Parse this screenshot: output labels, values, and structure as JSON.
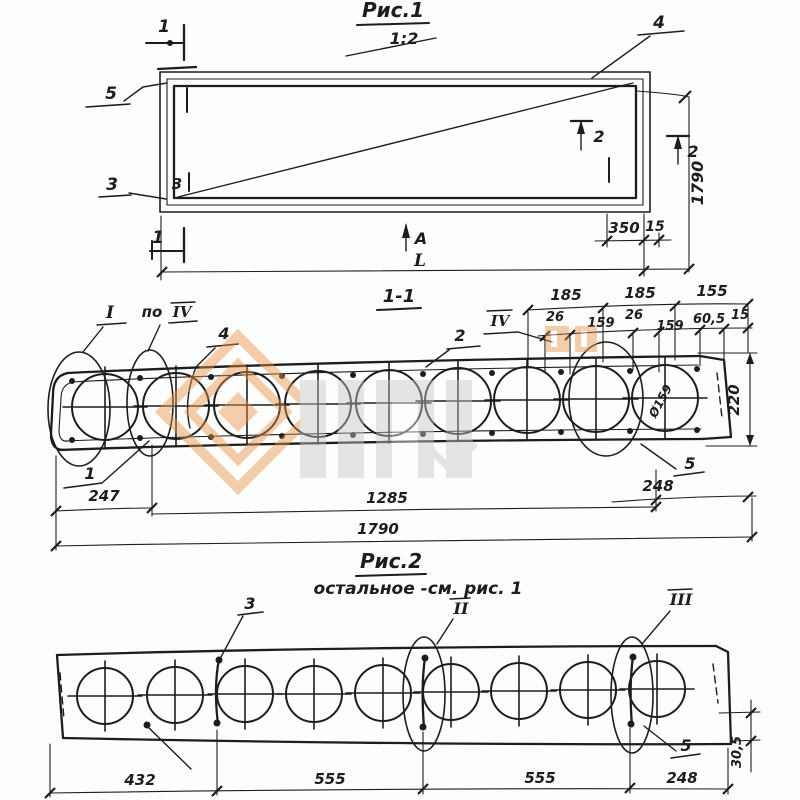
{
  "fig1": {
    "title": "Рис.1",
    "scale": "1:2",
    "section_mark_top": "1",
    "section_mark_bottom": "1",
    "callout_5": "5",
    "callout_3": "3",
    "inner_mark_3": "3",
    "callout_4": "4",
    "section_mark_2_inner": "2",
    "section_mark_2_outer": "2",
    "dim_width": "1790",
    "dim_350": "350",
    "dim_15": "15",
    "view_arrow": "A",
    "dim_length": "L"
  },
  "section1": {
    "title": "1-1",
    "detail_mark_I": "I",
    "po_label": "по",
    "po_ref": "IV",
    "callout_4": "4",
    "callout_2": "2",
    "mark_IV": "IV",
    "dims_top": [
      "185",
      "185",
      "155"
    ],
    "dims_sub": [
      "26",
      "159",
      "26",
      "159",
      "60,5",
      "15"
    ],
    "dim_height": "220",
    "core_diameter": "Ø159",
    "callout_5": "5",
    "callout_1": "1",
    "dim_left_end": "247",
    "dim_span": "1285",
    "dim_right_end": "248",
    "dim_total": "1790"
  },
  "fig2": {
    "title": "Рис.2",
    "note": "остальное -см. рис. 1",
    "callout_3": "3",
    "detail_mark_II": "II",
    "detail_mark_III": "III",
    "callout_5": "5",
    "dim_edge": "30,5",
    "dims_bottom": [
      "432",
      "555",
      "555",
      "248"
    ]
  },
  "watermark": {
    "orange": "#e8954a",
    "gray": "#c6c6c6"
  }
}
